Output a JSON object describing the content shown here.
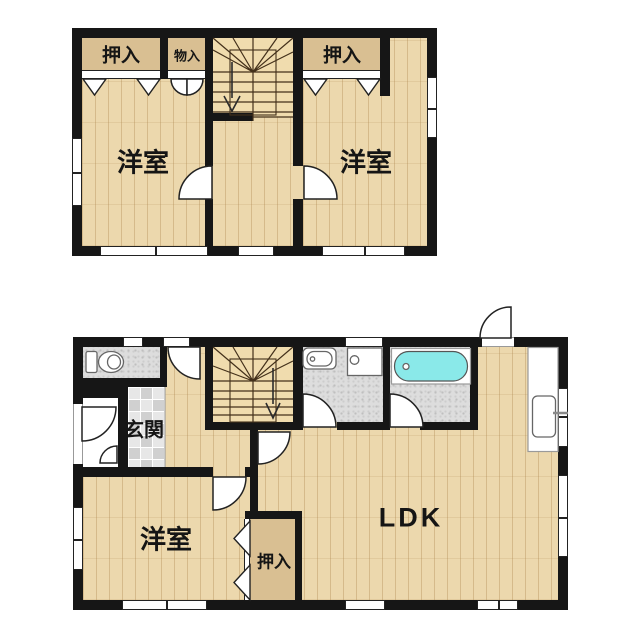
{
  "floor2": {
    "closet_left_label": "押入",
    "storage_label": "物入",
    "bedroom_left_label": "洋室",
    "closet_right_label": "押入",
    "bedroom_right_label": "洋室"
  },
  "floor1": {
    "entrance_label": "玄関",
    "bedroom_label": "洋室",
    "closet_label": "押入",
    "living_label": "LDK"
  },
  "colors": {
    "wall": "#161616",
    "line": "#222222",
    "wood": "#ecd8ad",
    "closet": "#d9bf92",
    "stairsbg": "#f0dcae",
    "grayfloor": "#dddddd",
    "tilea": "#d0d0d0",
    "tileb": "#e7e7e7",
    "tub": "#8ae9e9"
  }
}
